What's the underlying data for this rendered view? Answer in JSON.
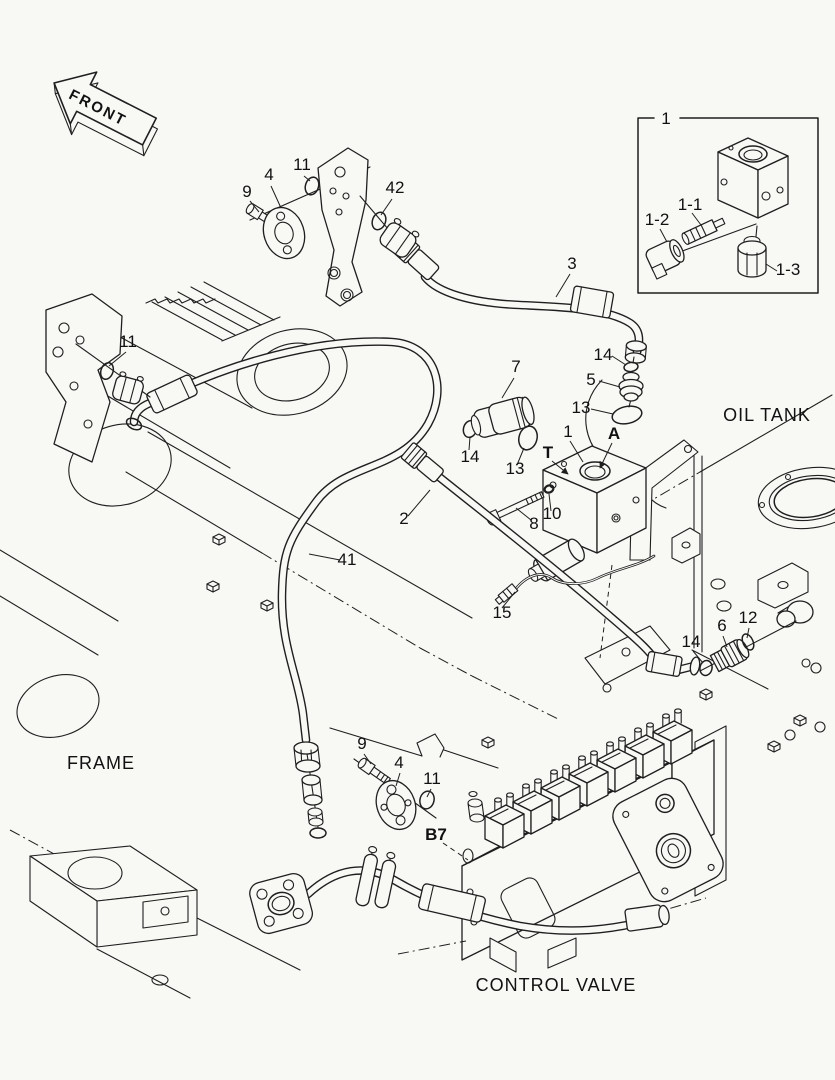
{
  "figure": {
    "colors": {
      "background": "#f8f8f5",
      "line": "#1f1f1f"
    },
    "front_marker": {
      "text": "FRONT"
    },
    "area_labels": {
      "oil_tank": "OIL TANK",
      "frame": "FRAME",
      "control_valve": "CONTROL VALVE"
    },
    "inset": {
      "box_number": "1",
      "sub_labels": [
        {
          "id": "1-1",
          "text": "1-1"
        },
        {
          "id": "1-2",
          "text": "1-2"
        },
        {
          "id": "1-3",
          "text": "1-3"
        }
      ]
    },
    "callouts": [
      {
        "id": "9-top",
        "text": "9"
      },
      {
        "id": "4-top",
        "text": "4"
      },
      {
        "id": "11-top",
        "text": "11"
      },
      {
        "id": "42",
        "text": "42"
      },
      {
        "id": "3",
        "text": "3"
      },
      {
        "id": "14-a",
        "text": "14"
      },
      {
        "id": "5",
        "text": "5"
      },
      {
        "id": "13-a",
        "text": "13"
      },
      {
        "id": "7",
        "text": "7"
      },
      {
        "id": "14-b",
        "text": "14"
      },
      {
        "id": "13-b",
        "text": "13"
      },
      {
        "id": "1-main",
        "text": "1"
      },
      {
        "id": "2",
        "text": "2"
      },
      {
        "id": "8",
        "text": "8"
      },
      {
        "id": "10",
        "text": "10"
      },
      {
        "id": "11-left",
        "text": "11"
      },
      {
        "id": "41",
        "text": "41"
      },
      {
        "id": "15",
        "text": "15"
      },
      {
        "id": "14-c",
        "text": "14"
      },
      {
        "id": "6",
        "text": "6"
      },
      {
        "id": "12",
        "text": "12"
      },
      {
        "id": "9-bottom",
        "text": "9"
      },
      {
        "id": "4-bottom",
        "text": "4"
      },
      {
        "id": "11-bottom",
        "text": "11"
      }
    ],
    "port_labels": [
      {
        "id": "A",
        "text": "A"
      },
      {
        "id": "T",
        "text": "T"
      },
      {
        "id": "B7",
        "text": "B7"
      }
    ]
  }
}
